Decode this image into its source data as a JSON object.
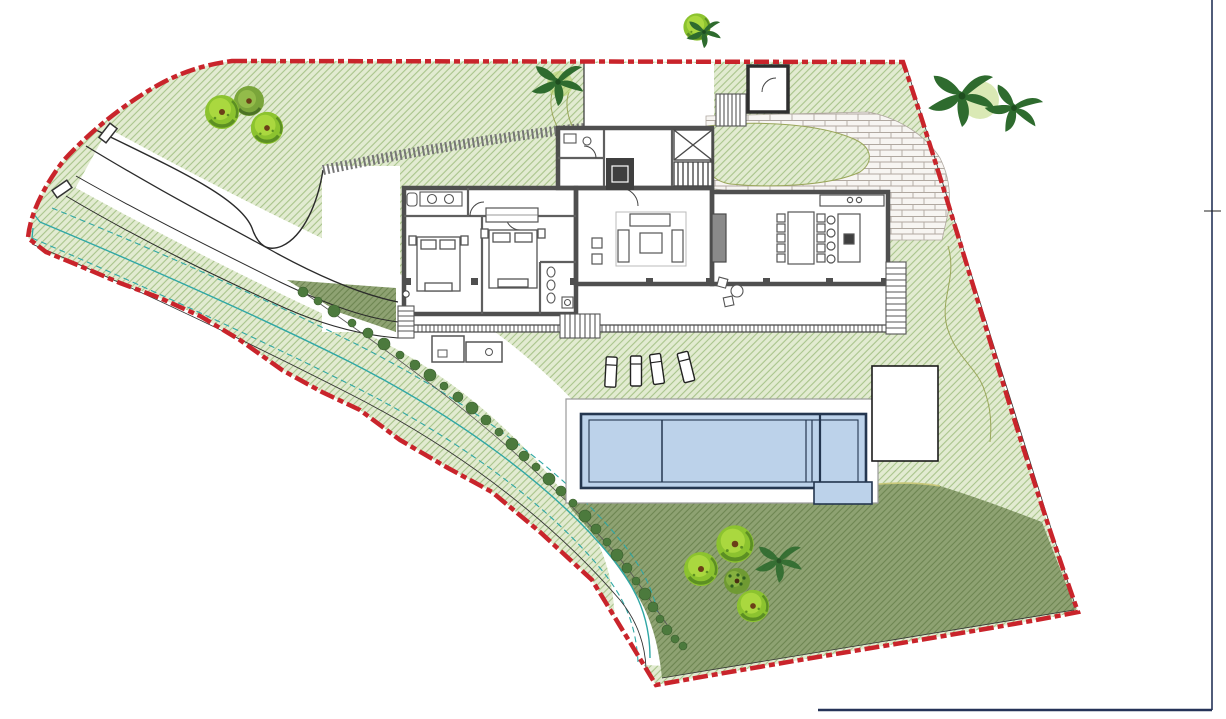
{
  "document": {
    "type": "architectural-site-plan",
    "view": "top-down villa plot plan",
    "visible_text": "none"
  },
  "colors": {
    "boundary": "#c9242b",
    "frame": "#253358",
    "lawn_light_base": "#e2ebd1",
    "lawn_light_hatch": "#a9c48b",
    "lawn_dark_base": "#8ea272",
    "lawn_dark_hatch": "#6d8551",
    "water": "#bcd2ea",
    "water_border": "#24364f",
    "wall": "#4f4f4f",
    "paving_bg": "#f7f5f2",
    "paving_line": "#b0a8a0",
    "stream": "#2fa7a5",
    "tree_light": "#aad83f",
    "tree_mid": "#8cc32f",
    "tree_shadow": "#5c8f23",
    "tree_olive": "#7aa53a",
    "palm": "#2e6b2e",
    "bush": "#4c7a3d",
    "contour": "#9aa65a",
    "path_edge": "#c8c87a"
  },
  "site": {
    "boundary_style": "red dashed surveyed plot line",
    "zones": [
      "upper lawn (light hatch)",
      "lower lawn (dark hatch)",
      "stone paving terrace",
      "white driveway corridor",
      "stream corridor with teal contour lines"
    ],
    "stream_contour_lines": 3,
    "gate_posts": 2,
    "retaining_tie_wall": true
  },
  "building": {
    "wings": [
      "bedroom wing",
      "entry core with stair and lift",
      "living hall",
      "dining-kitchen wing"
    ],
    "bedrooms": 2,
    "beds": 2,
    "bathrooms_visible": 3,
    "fireplace": true,
    "dining_chairs": 10,
    "kitchen_stools": 4,
    "south_columns": 8,
    "stair_flights_visible": 4
  },
  "pool": {
    "shape": "rectangular lap pool with spa section and L-extension",
    "divider_lines": 1,
    "lane_wall_lines": 3,
    "sun_loungers": 4,
    "deck": "white surround",
    "pavilion": "white rectangular deck/pool-house east of pool"
  },
  "landscape": {
    "trees_top_left_cluster": 3,
    "tree_top_center": 1,
    "palms_top": 3,
    "trees_bottom_cluster": 4,
    "palm_bottom": 1,
    "hedge_bushes_along_slope": 32
  }
}
